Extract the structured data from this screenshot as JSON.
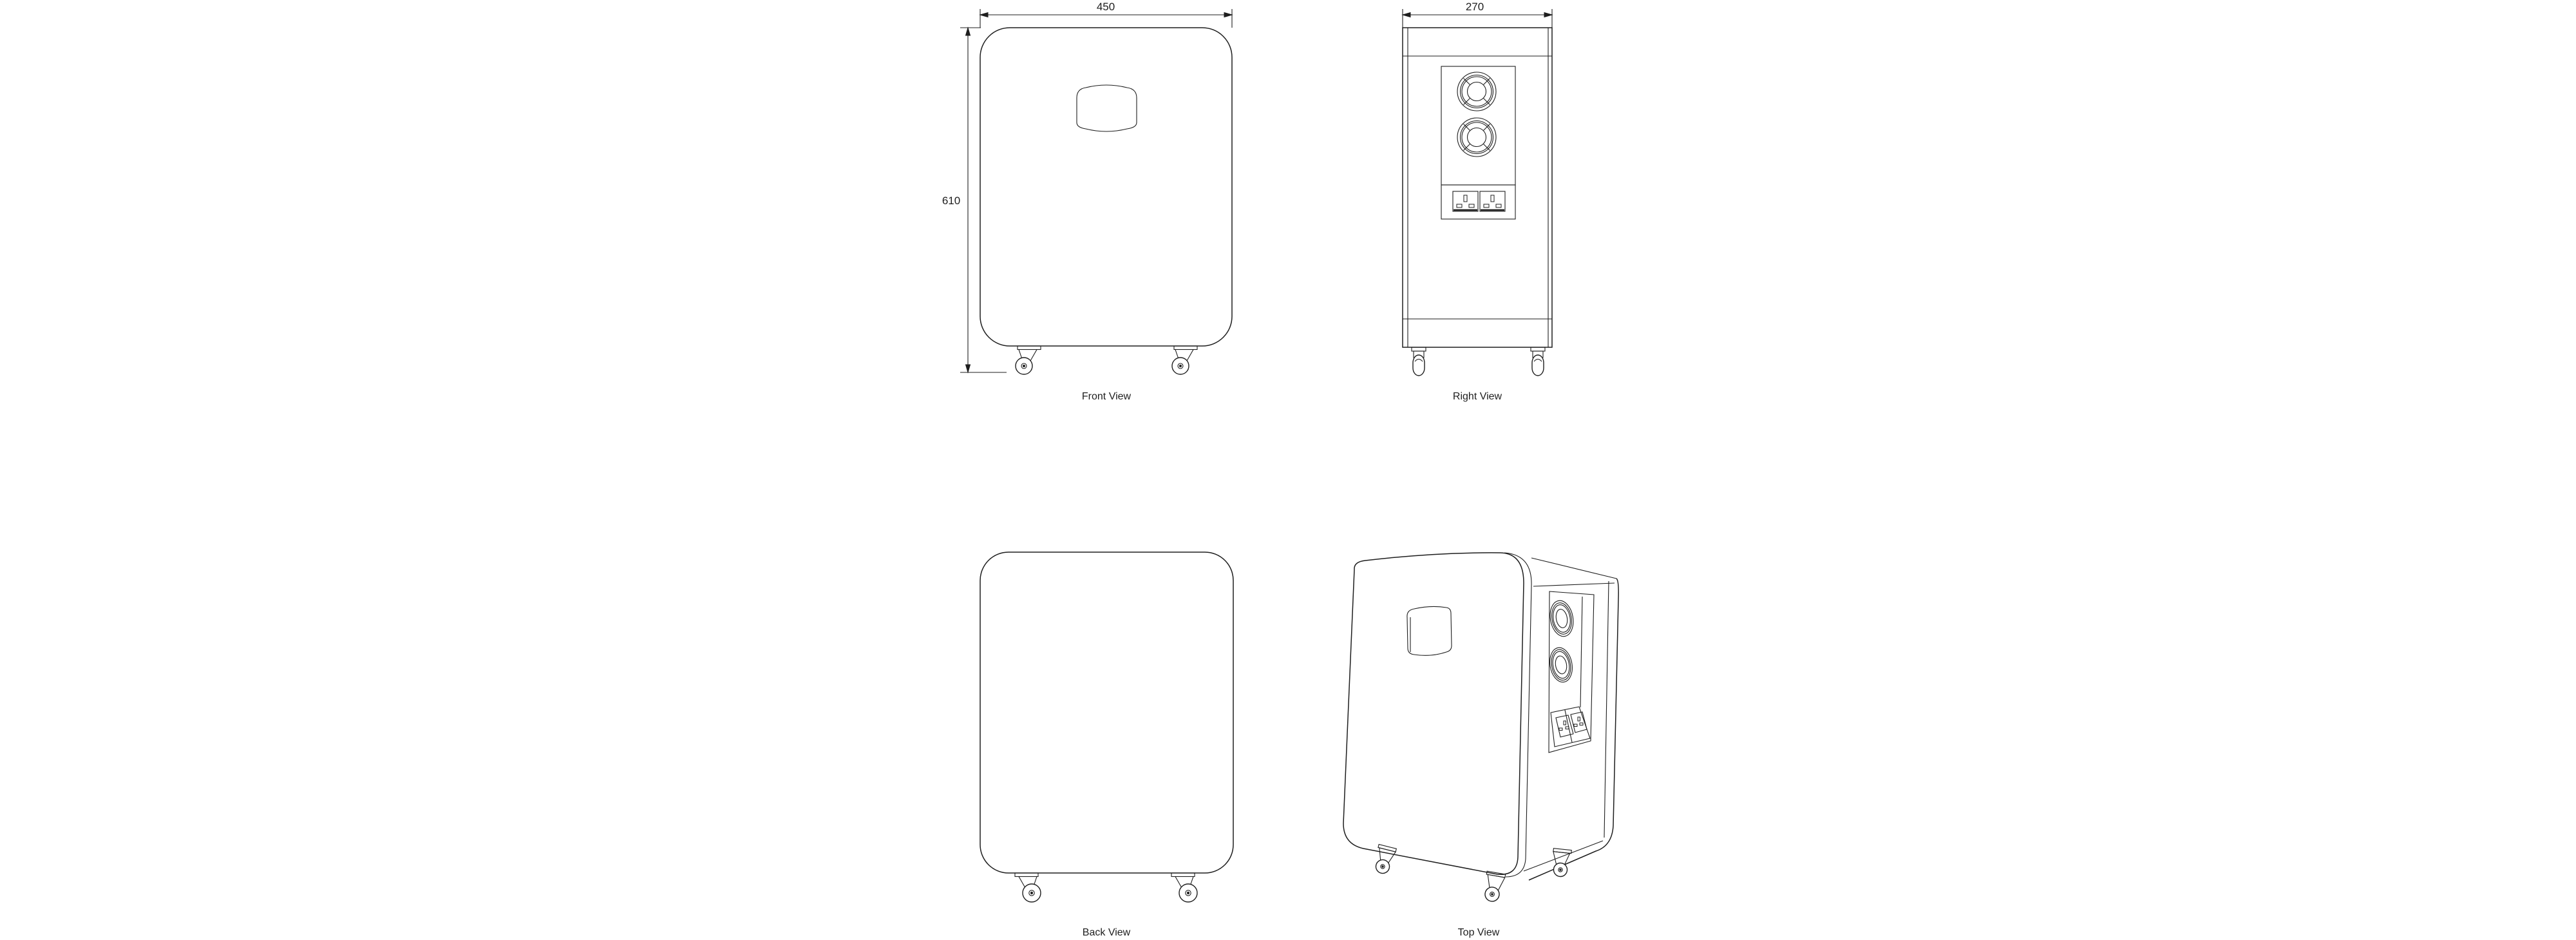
{
  "drawing": {
    "background_color": "#ffffff",
    "line_color": "#1e1e1e",
    "views": {
      "front": {
        "label": "Front View",
        "width_dim": "450",
        "height_dim": "610"
      },
      "right": {
        "label": "Right View",
        "width_dim": "270"
      },
      "back": {
        "label": "Back View"
      },
      "top": {
        "label": "Top View"
      }
    }
  }
}
